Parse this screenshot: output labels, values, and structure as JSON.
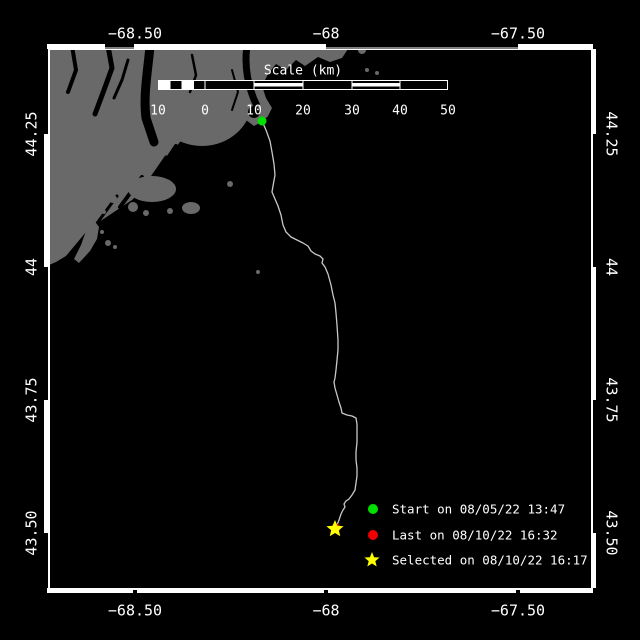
{
  "colors": {
    "background": "#000000",
    "water": "#000000",
    "land": "#696969",
    "frame": "#ffffff",
    "track": "#c8c8c8",
    "text": "#ffffff"
  },
  "axes": {
    "lon": [
      "−68.50",
      "−68",
      "−67.50"
    ],
    "lat": [
      "44.25",
      "44",
      "43.75",
      "43.50"
    ]
  },
  "scale_bar": {
    "title": "Scale (km)",
    "ticks": [
      "10",
      "0",
      "10",
      "20",
      "30",
      "40",
      "50"
    ]
  },
  "legend": {
    "items": [
      {
        "marker": "circle",
        "color": "#00e000",
        "label": "Start on 08/05/22 13:47"
      },
      {
        "marker": "circle",
        "color": "#f00000",
        "label": "Last on 08/10/22 16:32"
      },
      {
        "marker": "star",
        "color": "#ffff00",
        "label": "Selected on 08/10/22 16:17"
      }
    ]
  },
  "track": {
    "color": "#c8c8c8",
    "points": "262,121 266,130 270,141 272,152 274,164 275,175 273,186 272,192 275,199 278,206 281,215 283,225 286,232 291,237 297,240 303,243 308,246 311,251 315,254 320,256 323,259 322,263 325,267 328,274 331,285 333,295 335,303 336,313 337,325 338,340 338,350 337,360 336,370 335,378 334,382 335,388 337,395 339,402 341,408 342,413 347,415 352,416 356,418 357,424 357,432 357,442 356,452 356,460 357,468 357,476 356,483 355,490 352,495 349,499 346,501 344,504 345,507 343,510 341,514 339,520 337,525 335,529"
  },
  "markers": {
    "start": {
      "color": "#00e000",
      "cx": "262",
      "cy": "121",
      "r": "4.5"
    },
    "last": {
      "color": "#f00000",
      "cx": "336",
      "cy": "528",
      "r": "4.5"
    },
    "selected": {
      "color": "#ffff00",
      "points": "335,520 337.4,525.8 343.6,526.2 338.8,530.2 340.3,536.3 335,533 329.7,536.3 331.2,530.2 326.4,526.2 332.6,525.8"
    }
  }
}
